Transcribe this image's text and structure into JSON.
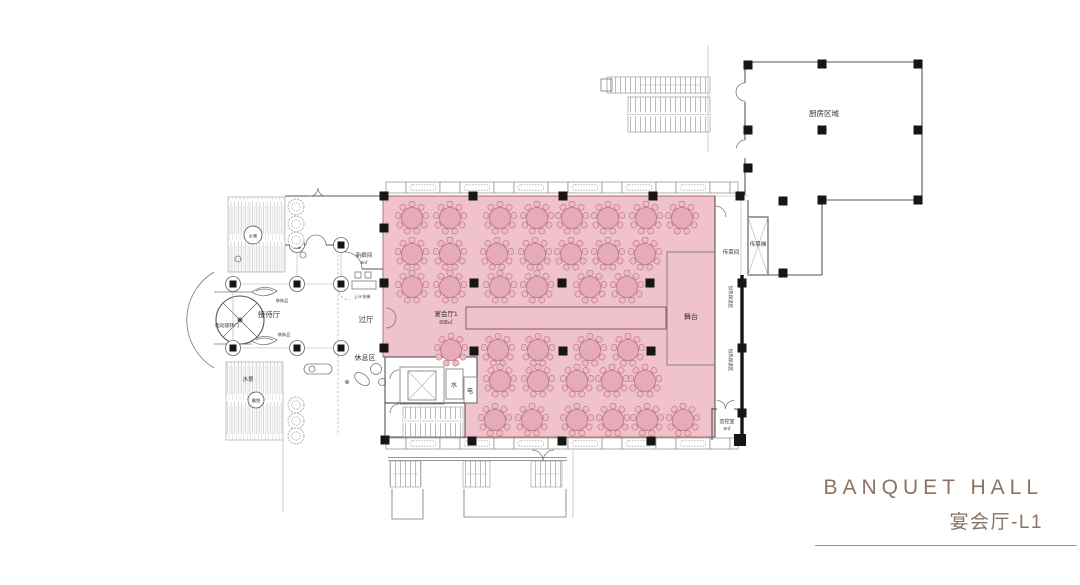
{
  "title_block": {
    "title_en": "BANQUET HALL",
    "title_cn": "宴会厅-L1"
  },
  "colors": {
    "hall_fill": "#f0c2cb",
    "table_fill": "#e9b0bb",
    "table_stroke": "#b57282",
    "wall": "#555555",
    "column": "#161616",
    "title_accent": "#8a7365"
  },
  "plan": {
    "labels": {
      "kitchen": "厨房区域",
      "hall_name": "宴会厅1",
      "hall_area": "608㎡",
      "stage": "舞台",
      "pass_room": "传菜间",
      "pass_lift": "传菜梯",
      "warm_zone_1": "加热保温区",
      "warm_zone_2": "加热保温区",
      "sound_room": "音控室",
      "sound_room_area": "8㎡",
      "bride_room": "新娘间",
      "bride_room_area": "8㎡",
      "vestibule": "过厅",
      "rest_area": "休息区",
      "reception": "接待厅",
      "revolving_door": "电动旋转门",
      "decoration_1": "装饰品",
      "decoration_2": "装饰品",
      "water_top": "水景",
      "water_bottom": "水景",
      "sculpture": "雕塑",
      "water_room": "水",
      "electric_room": "电",
      "escalator_note": "上2F扶梯"
    },
    "tables": [
      {
        "y": 218,
        "x": [
          412,
          450,
          500,
          537,
          572,
          608,
          646,
          682
        ]
      },
      {
        "y": 254,
        "x": [
          412,
          450,
          497,
          535,
          571,
          608,
          645
        ]
      },
      {
        "y": 287,
        "x": [
          412,
          450,
          500,
          537,
          590,
          627
        ]
      },
      {
        "y": 350,
        "x": [
          451,
          498,
          538,
          590,
          628
        ]
      },
      {
        "y": 381,
        "x": [
          500,
          538,
          577,
          612,
          645
        ]
      },
      {
        "y": 420,
        "x": [
          495,
          532,
          577,
          613,
          647,
          683
        ]
      }
    ],
    "columns": [
      [
        384,
        196
      ],
      [
        473,
        196
      ],
      [
        563,
        196
      ],
      [
        653,
        196
      ],
      [
        740,
        196
      ],
      [
        384,
        228
      ],
      [
        384,
        283
      ],
      [
        384,
        348
      ],
      [
        474,
        283
      ],
      [
        562,
        283
      ],
      [
        650,
        283
      ],
      [
        474,
        351
      ],
      [
        563,
        351
      ],
      [
        651,
        351
      ],
      [
        472,
        441
      ],
      [
        562,
        441
      ],
      [
        651,
        441
      ],
      [
        385,
        440
      ],
      [
        742,
        283
      ],
      [
        742,
        348
      ],
      [
        742,
        413
      ],
      [
        740,
        440,
        12
      ],
      [
        748,
        65
      ],
      [
        822,
        64
      ],
      [
        918,
        64
      ],
      [
        748,
        130
      ],
      [
        822,
        130
      ],
      [
        918,
        130
      ],
      [
        748,
        168
      ],
      [
        783,
        201
      ],
      [
        822,
        200
      ],
      [
        918,
        200
      ],
      [
        783,
        273
      ]
    ],
    "circled_columns": [
      [
        297,
        245
      ],
      [
        341,
        245
      ],
      [
        233,
        284
      ],
      [
        297,
        284
      ],
      [
        341,
        284
      ],
      [
        233,
        348
      ],
      [
        297,
        348
      ],
      [
        341,
        348
      ]
    ],
    "plants": [
      [
        296,
        207
      ],
      [
        296,
        224
      ],
      [
        296,
        240
      ],
      [
        296,
        405
      ],
      [
        296,
        421
      ],
      [
        296,
        436
      ]
    ]
  }
}
